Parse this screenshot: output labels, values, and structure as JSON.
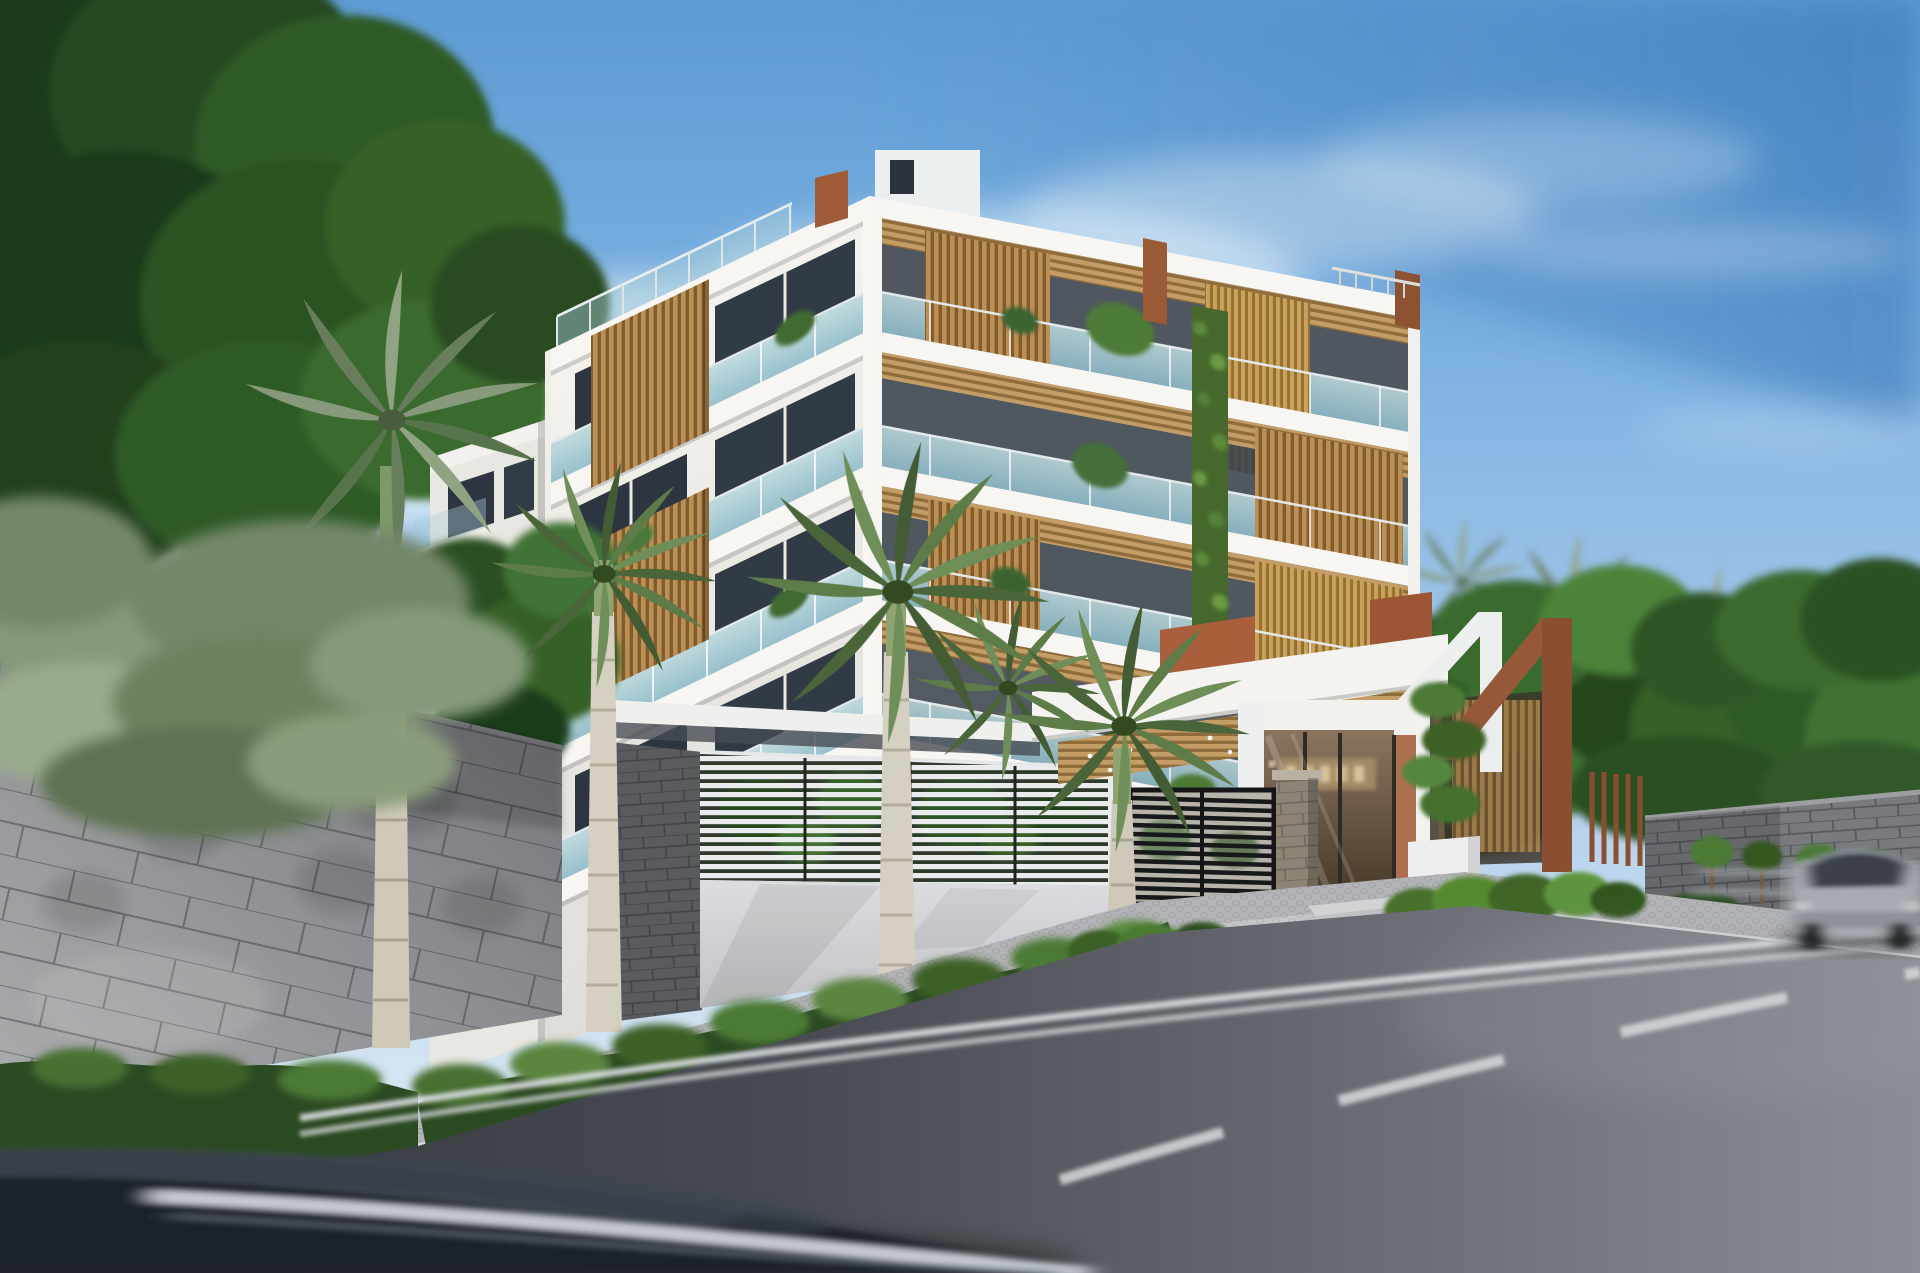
{
  "meta": {
    "kind": "architectural-exterior-rendering",
    "width_px": 1920,
    "height_px": 1273,
    "time_of_day": "day"
  },
  "scene": {
    "caption": "Daytime architectural rendering of a modern six-story white apartment building with golden wood-slat screens, glass balconies and a vertical garden strip, fronted by royal palms, a gray tiled perimeter wall, a white louvered screen wall, a gated entrance lobby with an illegible bronze sign, corten-steel pergolas, dense tropical trees, and an asphalt street with two motion-blurred passing cars.",
    "entrance_sign": {
      "legible": false
    },
    "vehicles": {
      "foreground": "dark sedan, motion-blurred, bottom left",
      "oncoming": "silver car, motion-blurred, right edge"
    }
  },
  "palette": {
    "sky_top": "#5d9bd3",
    "sky_mid": "#a6c9ea",
    "sky_horizon": "#e3ecf3",
    "cloud": "#f3f7fb",
    "foliage_dark": "#1c3a1b",
    "foliage_mid": "#356128",
    "foliage_light": "#4c8338",
    "palm_sage": "#86997a",
    "building_white": "#f4f2ed",
    "building_shade": "#e2e0da",
    "window_dark": "#2c3540",
    "glass_balcony": "#a7cdd6",
    "wood_slat": "#bd8f52",
    "wood_soffit": "#c49d66",
    "green_wall": "#46682c",
    "corten": "#97583a",
    "terracotta": "#a95f3c",
    "tile_wall": "#8d8f93",
    "louver_white": "#e9ebed",
    "hedge": "#2d4d23",
    "sidewalk": "#b3b4b7",
    "asphalt_dark": "#33373d",
    "asphalt_light": "#83878d",
    "road_marking": "#d7dade",
    "car_dark": "#1d222a",
    "car_silver": "#a6abb1",
    "lobby_bronze": "#6b5747",
    "stone_pillar": "#8d8476"
  },
  "objects": [
    {
      "name": "sky",
      "label": "blue sky with diagonal cirrus band"
    },
    {
      "name": "left-canopy-tree",
      "label": "dark leafy tree, top-left corner"
    },
    {
      "name": "left-royal-palm",
      "label": "tall royal palm in front of tile wall"
    },
    {
      "name": "perimeter-tile-wall",
      "label": "gray concrete tile perimeter wall"
    },
    {
      "name": "privacy-louver-wall",
      "label": "white horizontal louver screen wall"
    },
    {
      "name": "main-building",
      "label": "six-story white residential building, corner view"
    },
    {
      "name": "green-wall",
      "label": "vertical garden strip on right facade"
    },
    {
      "name": "entrance-lobby",
      "label": "glass entrance lobby with bronze sign"
    },
    {
      "name": "driveway-gate",
      "label": "black horizontal-slat driveway gate"
    },
    {
      "name": "pergola-corten",
      "label": "corten steel angular pergola frames"
    },
    {
      "name": "street-palms",
      "label": "royal palms along the frontage"
    },
    {
      "name": "hedge-row",
      "label": "clipped hedge along walls"
    },
    {
      "name": "distant-building",
      "label": "white apartment block on the horizon"
    },
    {
      "name": "right-block-wall",
      "label": "gray block wall along street, right side"
    },
    {
      "name": "road",
      "label": "asphalt street with dashed center line and edge lines"
    },
    {
      "name": "foreground-car",
      "label": "motion-blurred dark car in foreground"
    },
    {
      "name": "oncoming-car",
      "label": "motion-blurred silver car at right"
    }
  ]
}
